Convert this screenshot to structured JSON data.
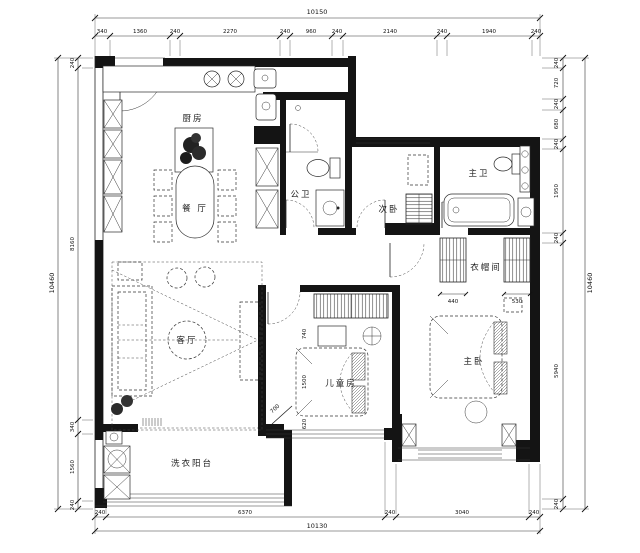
{
  "drawing": {
    "kind": "residential floor plan (CAD)",
    "rooms": {
      "kitchen": "厨房",
      "dining": "餐 厅",
      "living": "客厅",
      "guest_bath": "公卫",
      "second_bedroom": "次卧",
      "master_bath": "主卫",
      "closet": "衣帽间",
      "kids_room": "儿童房",
      "master_bedroom": "主卧",
      "laundry_balcony": "洗衣阳台"
    },
    "dims": {
      "top": {
        "total": "10150",
        "segments": [
          "340",
          "1360",
          "240",
          "2270",
          "240",
          "960",
          "240",
          "2140",
          "240",
          "1940",
          "240"
        ]
      },
      "bottom": {
        "total": "10130",
        "segments": [
          "240",
          "6370",
          "240",
          "3040",
          "240"
        ]
      },
      "left": {
        "total": "10460",
        "segments": [
          "240",
          "8160",
          "340",
          "1560",
          "240"
        ]
      },
      "right": {
        "total": "10460",
        "segments": [
          "240",
          "720",
          "240",
          "680",
          "240",
          "1950",
          "240",
          "5940",
          "240"
        ]
      }
    },
    "annotations": {
      "closet_left": "440",
      "closet_right": "530",
      "kids_top": "740",
      "kids_mid": "1500",
      "kids_bottom": "620",
      "kids_diag": "700"
    }
  }
}
